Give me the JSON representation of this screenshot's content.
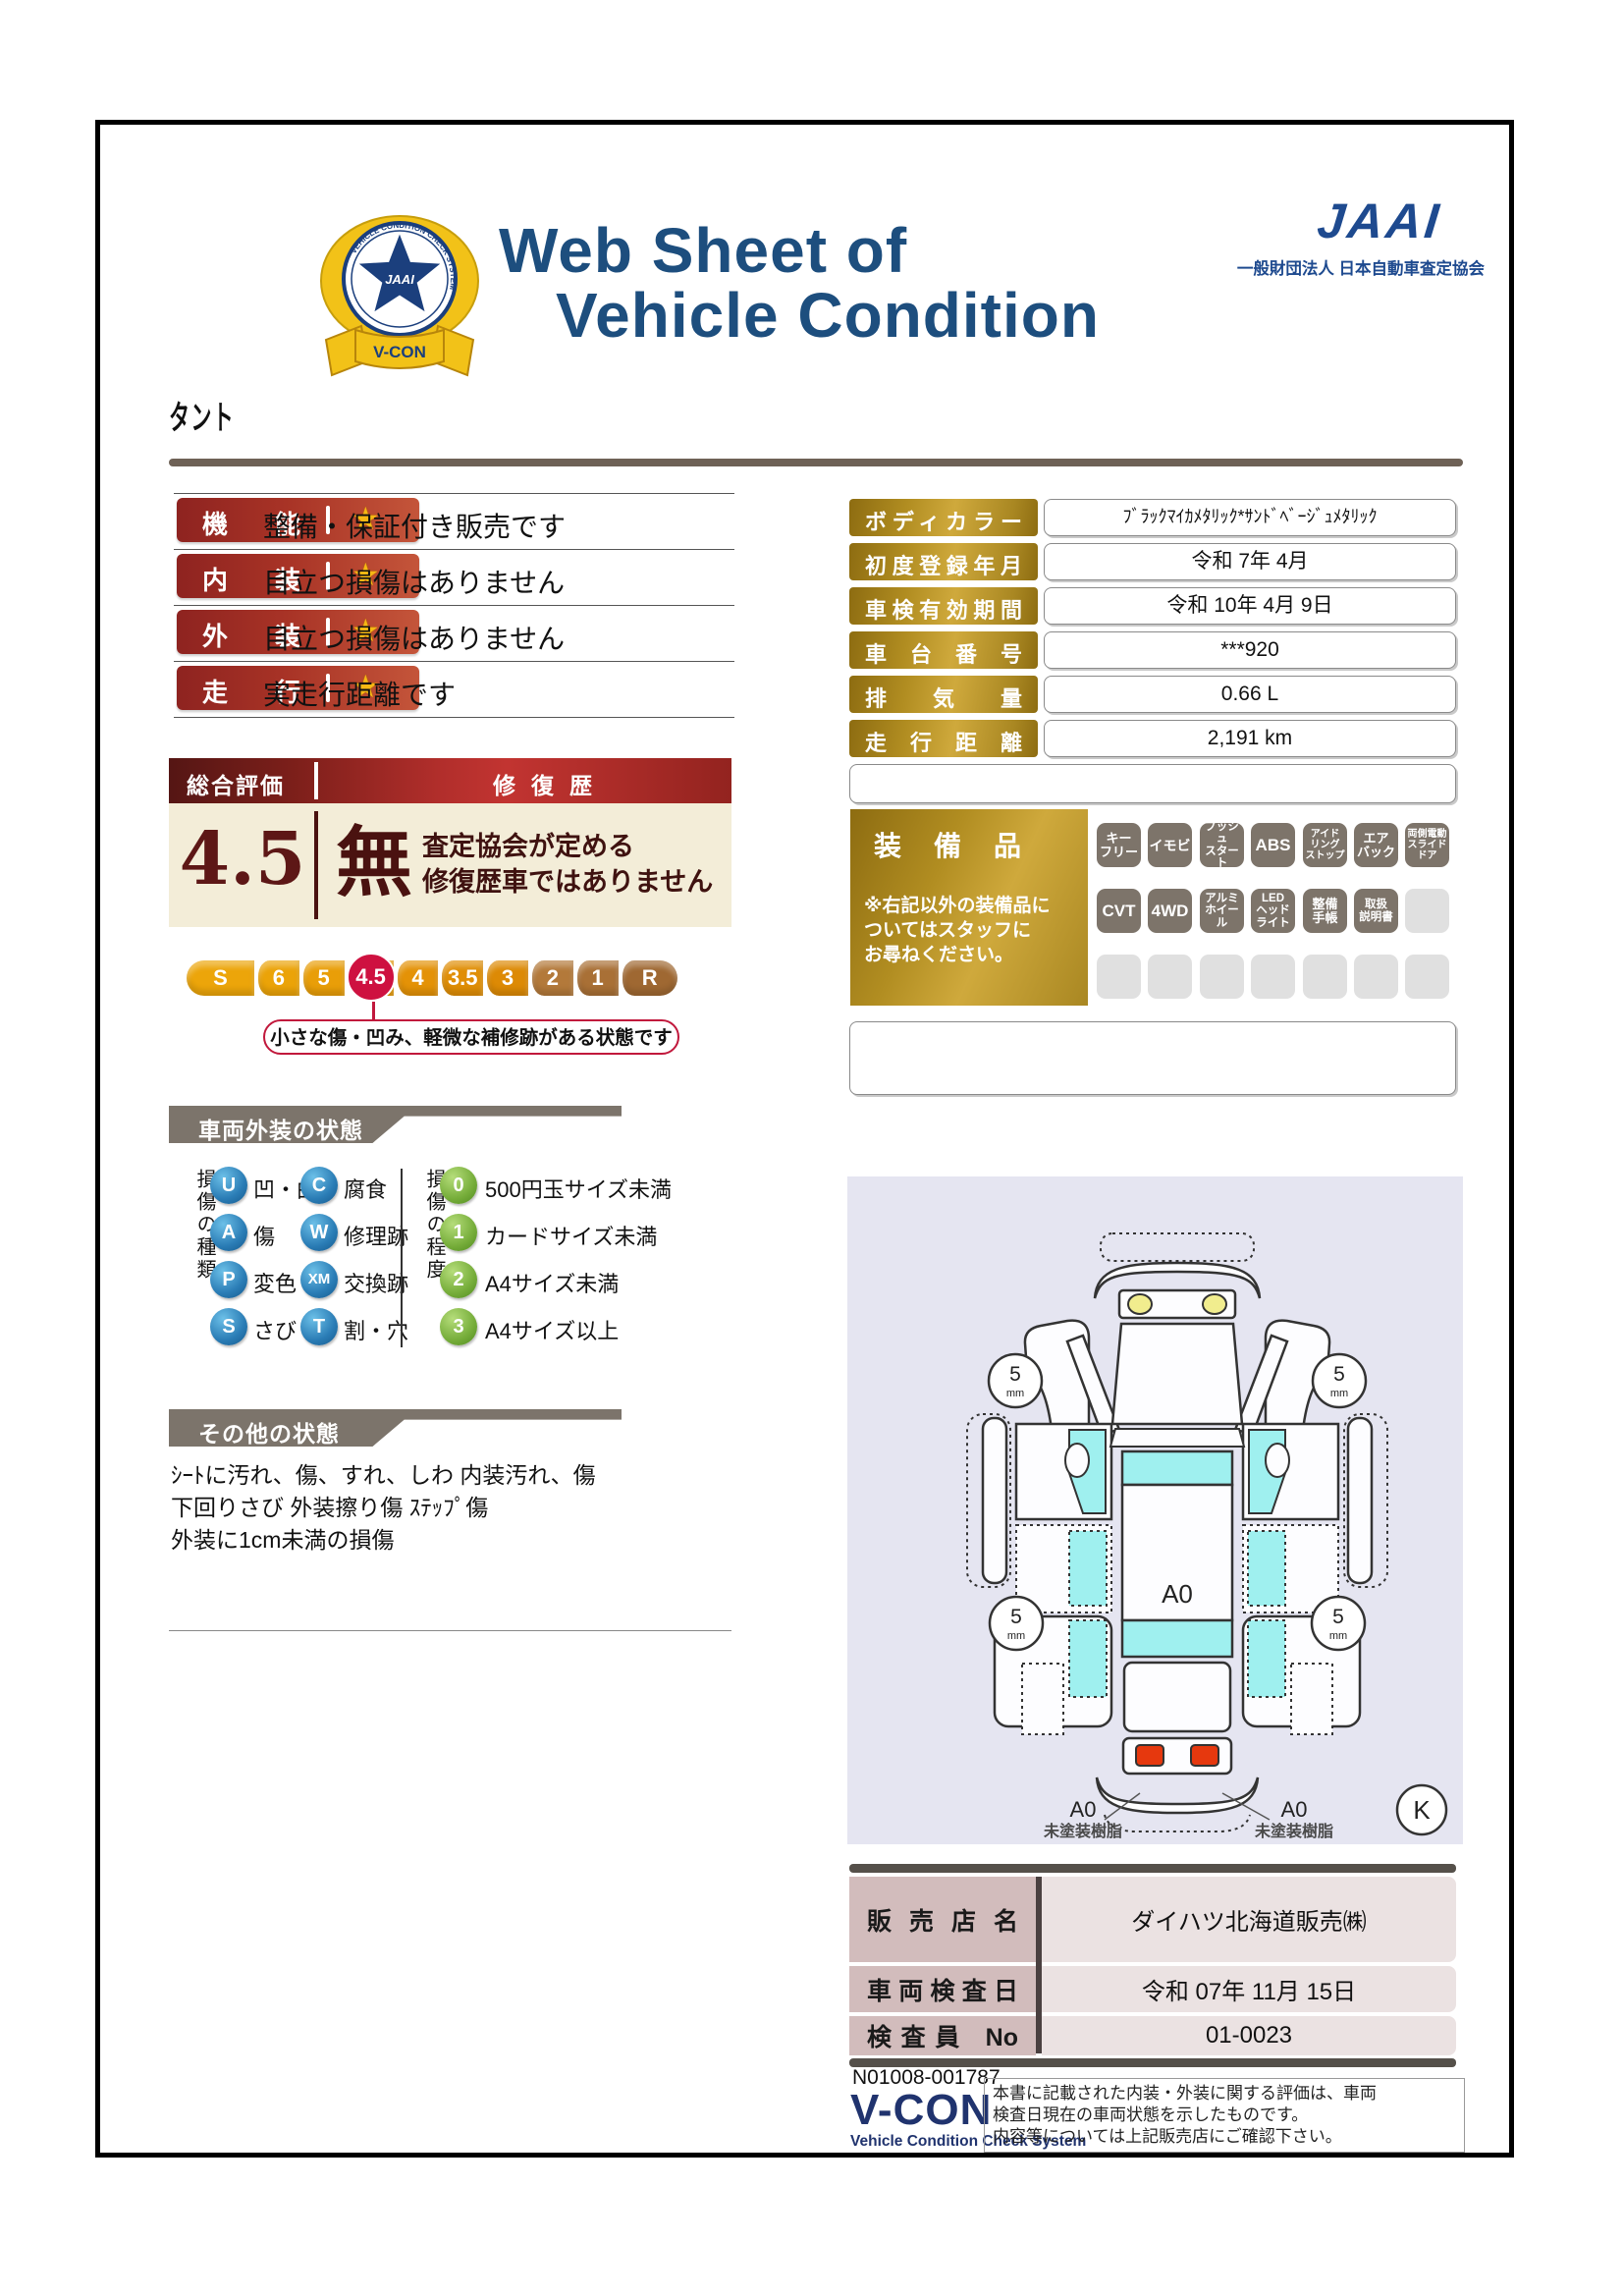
{
  "header": {
    "title1": "Web Sheet of",
    "title2": "Vehicle Condition",
    "jaai": "JAAI",
    "org": "一般財団法人 日本自動車査定協会",
    "emblem_center": "JAAI",
    "emblem_ring": "VEHICLE CONDITION CHECK SYSTEM",
    "emblem_ribbon": "V-CON"
  },
  "vehicle_name": "タント",
  "ratings_star": "★",
  "ratings": [
    {
      "label": "機能",
      "desc": "整備・保証付き販売です"
    },
    {
      "label": "内装",
      "desc": "目立つ損傷はありません"
    },
    {
      "label": "外装",
      "desc": "目立つ損傷はありません"
    },
    {
      "label": "走行",
      "desc": "実走行距離です"
    }
  ],
  "overall": {
    "score_label": "総合評価点",
    "score": "4.5",
    "repair_label": "修復歴",
    "repair_value": "無",
    "repair_note": "査定協会が定める\n修復歴車ではありません",
    "scale": [
      "S",
      "6",
      "5",
      "4.5",
      "4",
      "3.5",
      "3",
      "2",
      "1",
      "R"
    ],
    "selected": "4.5",
    "callout": "小さな傷・凹み、軽微な補修跡がある状態です"
  },
  "details": [
    {
      "label": "ボディカラー",
      "value": "ﾌﾞﾗｯｸﾏｲｶﾒﾀﾘｯｸ*ｻﾝﾄﾞﾍﾞｰｼﾞｭﾒﾀﾘｯｸ"
    },
    {
      "label": "初度登録年月",
      "value": "令和 7年 4月"
    },
    {
      "label": "車検有効期間",
      "value": "令和 10年 4月 9日"
    },
    {
      "label": "車台番号",
      "value": "***920"
    },
    {
      "label": "排気量",
      "value": "0.66 L"
    },
    {
      "label": "走行距離",
      "value": "2,191 km"
    }
  ],
  "equipment": {
    "title": "装備品",
    "note": "※右記以外の装備品に\nついてはスタッフに\nお尋ねください。",
    "r1": [
      "キー\nフリー",
      "イモビ",
      "プッシュ\nスタート",
      "ABS",
      "アイド\nリング\nストップ",
      "エア\nバック",
      "両側電動\nスライド\nドア"
    ],
    "r2": [
      "CVT",
      "4WD",
      "アルミ\nホイール",
      "LED\nヘッド\nライト",
      "整備\n手帳",
      "取扱\n説明書"
    ]
  },
  "exterior": {
    "title": "車両外装の状態",
    "type_label": "損傷の種類",
    "types": [
      {
        "code": "U",
        "name": "凹・曲"
      },
      {
        "code": "C",
        "name": "腐食"
      },
      {
        "code": "A",
        "name": "傷"
      },
      {
        "code": "W",
        "name": "修理跡"
      },
      {
        "code": "P",
        "name": "変色"
      },
      {
        "code": "XM",
        "name": "交換跡"
      },
      {
        "code": "S",
        "name": "さび"
      },
      {
        "code": "T",
        "name": "割・穴"
      }
    ],
    "degree_label": "損傷の程度",
    "degrees": [
      {
        "code": "0",
        "name": "500円玉サイズ未満"
      },
      {
        "code": "1",
        "name": "カードサイズ未満"
      },
      {
        "code": "2",
        "name": "A4サイズ未満"
      },
      {
        "code": "3",
        "name": "A4サイズ以上"
      }
    ]
  },
  "other": {
    "title": "その他の状態",
    "lines": "ｼｰﾄに汚れ、傷、すれ、しわ 内装汚れ、傷\n下回りさび 外装擦り傷 ｽﾃｯﾌﾟ傷\n外装に1cm未満の損傷"
  },
  "diagram": {
    "tread": "5",
    "tread_unit": "mm",
    "roof_label": "A0",
    "bumper_label": "A0",
    "bumper_note": "未塗装樹脂",
    "corner_mark": "K"
  },
  "dealer": [
    {
      "label": "販売店名",
      "value": "ダイハツ北海道販売㈱"
    },
    {
      "label": "車両検査日",
      "value": "令和 07年 11月 15日"
    },
    {
      "label": "検査員 No",
      "value": "01-0023"
    }
  ],
  "footer": {
    "doc": "N01008-001787",
    "logo": "V-CON",
    "sub": "Vehicle Condition Check System",
    "note": "本書に記載された内装・外装に関する評価は、車両\n検査日現在の車両状態を示したものです。\n内容等については上記販売店にご確認下さい。"
  },
  "colors": {
    "navy": "#1d4e7e",
    "gold": "#b18d21",
    "rating_red": "#c4553a",
    "maroon": "#5d1716",
    "crimson": "#ce1140",
    "banner_gray": "#7c746b",
    "window_cyan": "#9ff0ef"
  }
}
